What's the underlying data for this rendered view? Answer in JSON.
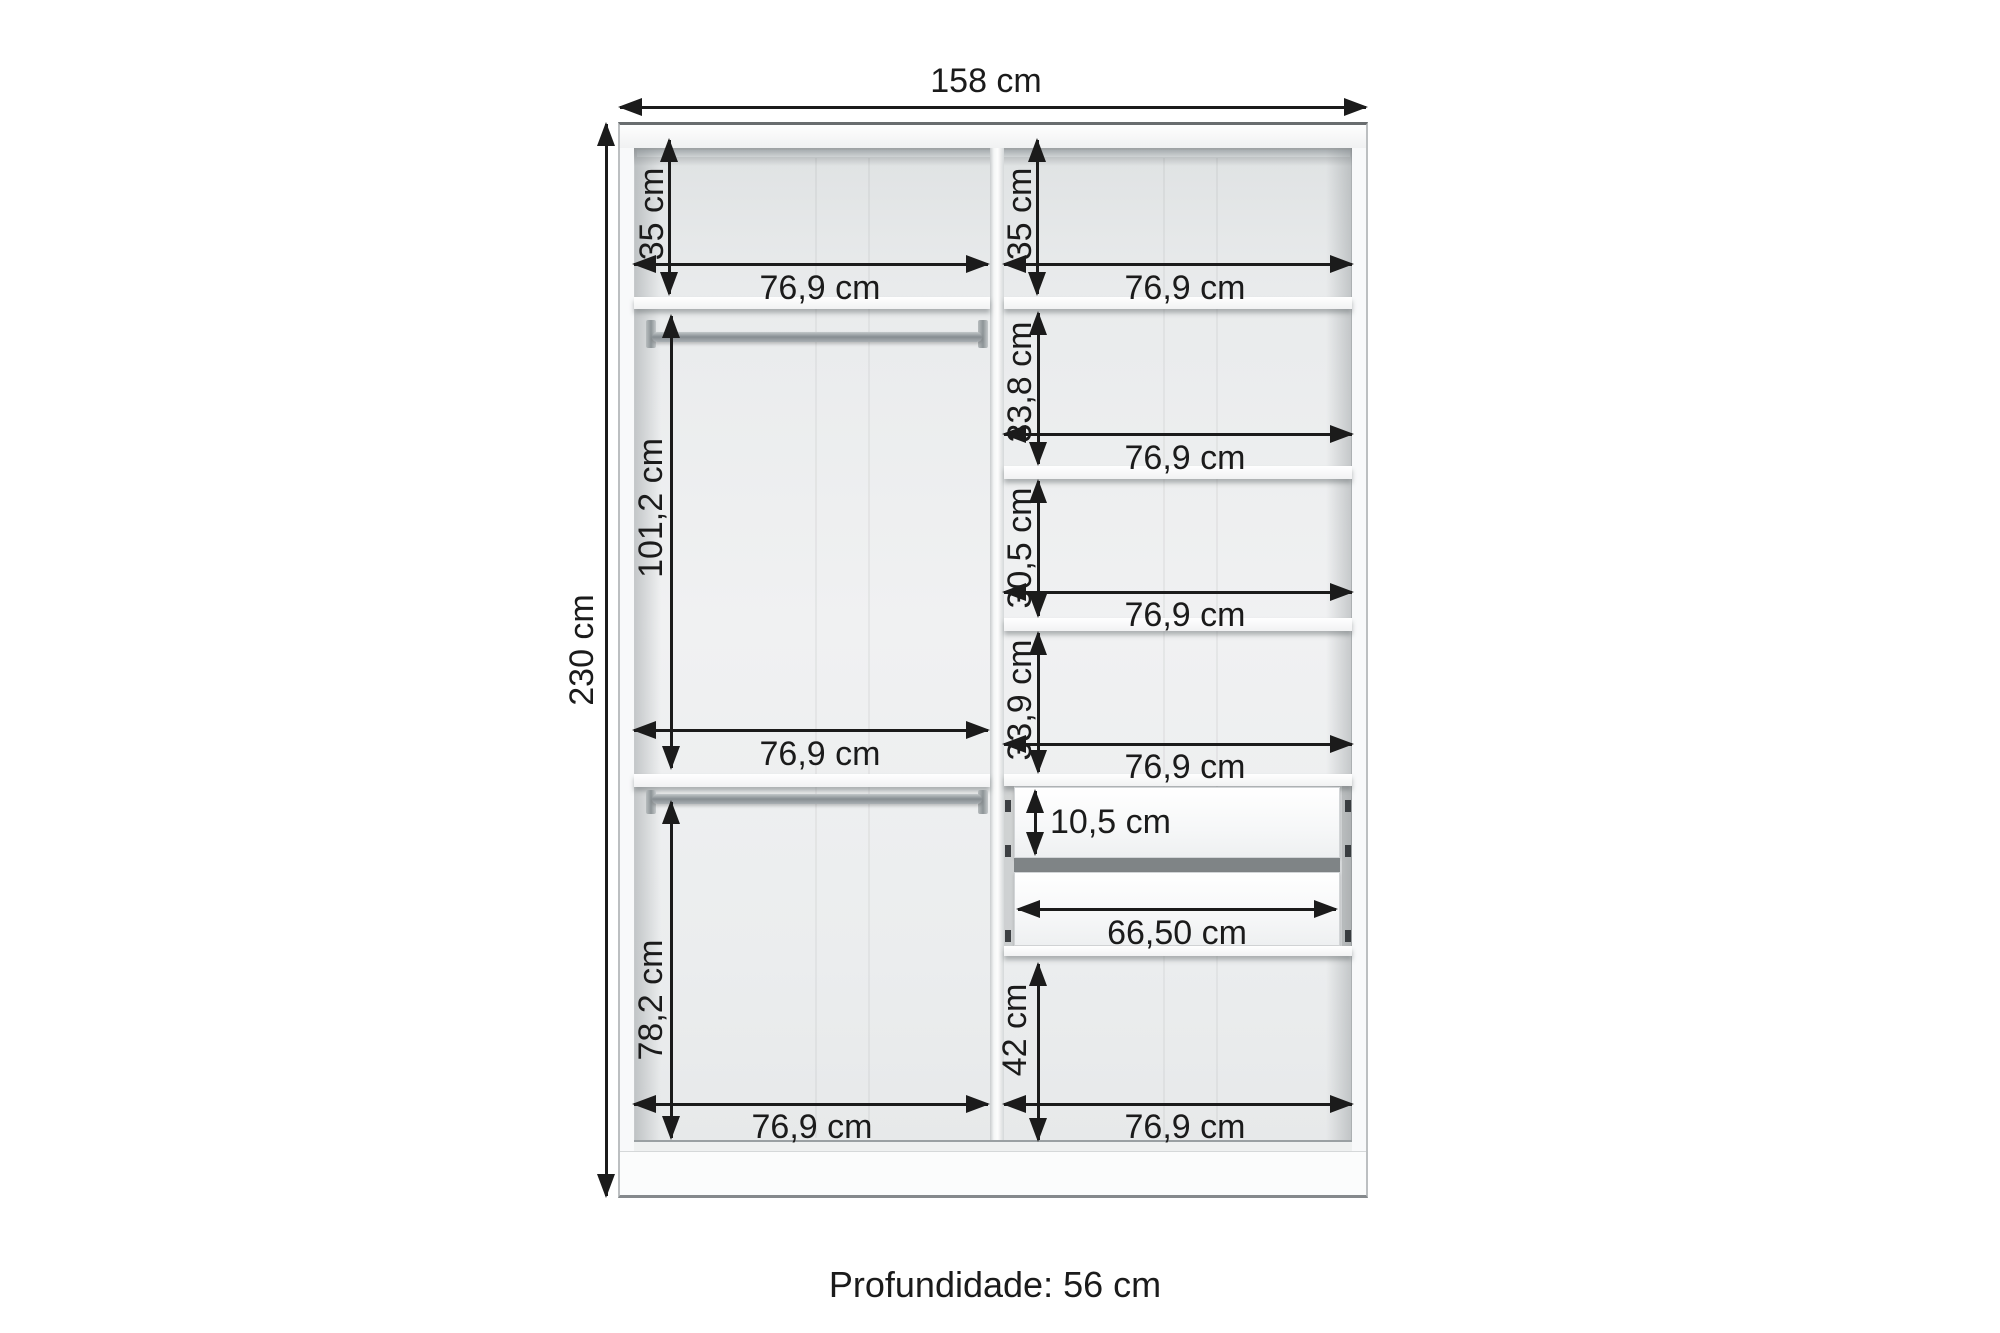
{
  "diagram": {
    "depth_note": "Profundidade: 56 cm",
    "overall": {
      "width": "158 cm",
      "height": "230 cm"
    },
    "left_column": {
      "top_section_height": "35 cm",
      "top_section_width": "76,9 cm",
      "hanging_section_height": "101,2 cm",
      "middle_width": "76,9 cm",
      "lower_section_height": "78,2 cm",
      "bottom_width": "76,9 cm"
    },
    "right_column": {
      "top_section_height": "35 cm",
      "top_section_width": "76,9 cm",
      "section2_height": "33,8 cm",
      "section2_width": "76,9 cm",
      "section3_height": "30,5 cm",
      "section3_width": "76,9 cm",
      "section4_height": "33,9 cm",
      "section4_width": "76,9 cm",
      "drawer_front_height": "10,5 cm",
      "drawer_width": "66,50 cm",
      "lower_section_height": "42 cm",
      "bottom_width": "76,9 cm"
    },
    "colors": {
      "dimension_ink": "#1b1b1b",
      "interior_gray": "#eceeee",
      "panel_white": "#fbfcfc",
      "background": "#ffffff"
    }
  }
}
